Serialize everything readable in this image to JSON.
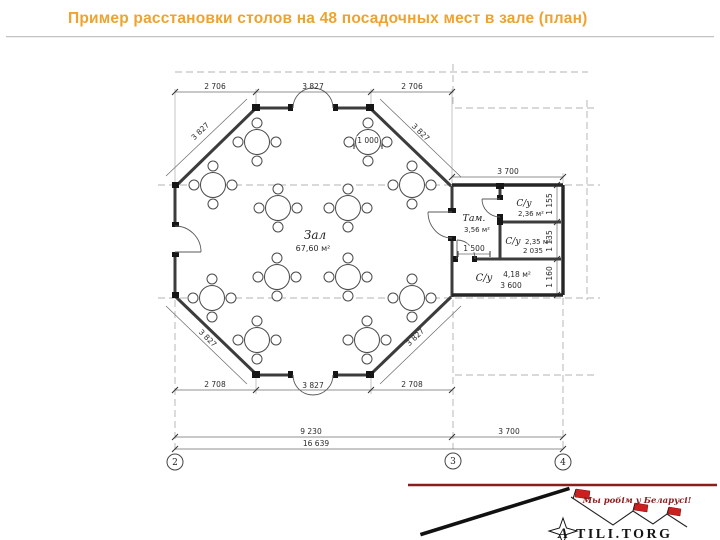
{
  "slide": {
    "title": "Пример расстановки столов на 48 посадочных мест в зале (план)"
  },
  "colors": {
    "title_orange": "#EFA32F",
    "logo_dark_red": "#8B1D1D",
    "flag_red": "#CC1F1F",
    "drawing_line": "#3c3c3c"
  },
  "plan": {
    "rooms": {
      "hall": {
        "name": "Зал",
        "area": "67,60 м²"
      },
      "tambour": {
        "name": "Там.",
        "area": "3,56 м²"
      },
      "wc_top": {
        "name": "С/у",
        "area": "2,36 м²"
      },
      "wc_mid": {
        "name": "С/у",
        "area": "2,35 м²",
        "width": "2 035"
      },
      "wc_bottom": {
        "name": "С/у",
        "area": "4,18 м²",
        "width": "3 600"
      }
    },
    "dims": {
      "top_left": "2 706",
      "top_center": "3 827",
      "top_right": "2 706",
      "bottom_left": "2 708",
      "bottom_center": "3 827",
      "bottom_right": "2 708",
      "diag_top_left": "3 827",
      "diag_top_right": "3 827",
      "diag_bottom_left": "3 827",
      "diag_bottom_right": "3 827",
      "annex_top": "3 700",
      "side_top": "1 155",
      "side_mid": "1 135",
      "side_bottom": "1 160",
      "table_diameter": "1 000",
      "tambour_door": "1 500",
      "total_hall": "9 230",
      "total_annex": "3 700",
      "total_overall": "16 639"
    },
    "grid_markers": [
      "2",
      "3",
      "4"
    ],
    "tables": [
      [
        257,
        142
      ],
      [
        368,
        142
      ],
      [
        213,
        185
      ],
      [
        412,
        185
      ],
      [
        278,
        208
      ],
      [
        348,
        208
      ],
      [
        277,
        277
      ],
      [
        348,
        277
      ],
      [
        212,
        298
      ],
      [
        412,
        298
      ],
      [
        257,
        340
      ],
      [
        367,
        340
      ]
    ]
  },
  "logo": {
    "slogan": "Мы робім у Беларусі!",
    "brand_initial": "A",
    "brand_rest": "TILI.TORG"
  }
}
